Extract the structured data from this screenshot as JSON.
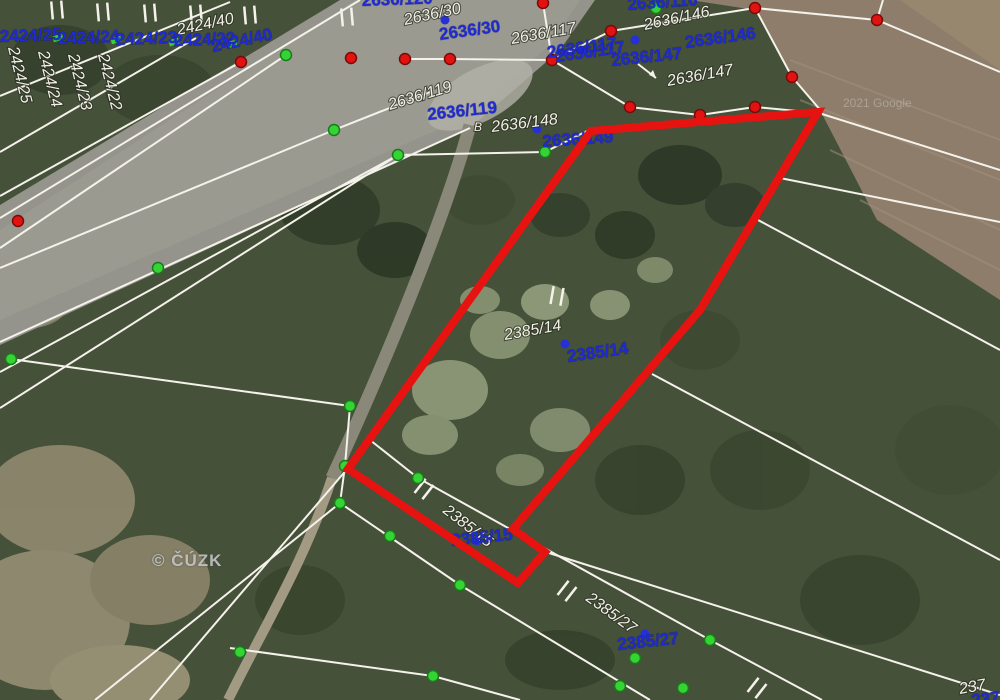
{
  "map": {
    "copyright": "© ČÚZK",
    "google_watermark": "2021 Google",
    "colors": {
      "highlight_red": "#e61310",
      "parcel_blue": "#1e2ad4",
      "boundary_white": "#f4f2ea",
      "point_green": "#35d435",
      "point_green_rim": "#1a7a1a",
      "point_red": "#e01310",
      "point_red_rim": "#7a0a08",
      "anchor_blue": "#2531d6"
    },
    "highlight_polygon": "818,112 591,131 348,469 518,583 545,552 513,529 700,310",
    "labels_white": [
      {
        "text": "2424/25",
        "x": 8,
        "y": 48,
        "rot": 76
      },
      {
        "text": "2424/24",
        "x": 38,
        "y": 52,
        "rot": 76
      },
      {
        "text": "2424/23",
        "x": 68,
        "y": 55,
        "rot": 76
      },
      {
        "text": "2424/22",
        "x": 98,
        "y": 55,
        "rot": 76
      },
      {
        "text": "2424/40",
        "x": 178,
        "y": 35,
        "rot": -12
      },
      {
        "text": "2636/30",
        "x": 405,
        "y": 25,
        "rot": -12
      },
      {
        "text": "2636/117",
        "x": 512,
        "y": 44,
        "rot": -10
      },
      {
        "text": "2636/119",
        "x": 390,
        "y": 110,
        "rot": -17
      },
      {
        "text": "B",
        "x": 474,
        "y": 131,
        "rot": 0,
        "size": 12
      },
      {
        "text": "2636/148",
        "x": 492,
        "y": 132,
        "rot": -7
      },
      {
        "text": "2636/146",
        "x": 645,
        "y": 30,
        "rot": -12
      },
      {
        "text": "2636/147",
        "x": 668,
        "y": 86,
        "rot": -10
      },
      {
        "text": "2385/14",
        "x": 505,
        "y": 340,
        "rot": -10
      },
      {
        "text": "2385/15",
        "x": 442,
        "y": 512,
        "rot": 38
      },
      {
        "text": "2385/27",
        "x": 585,
        "y": 600,
        "rot": 36
      },
      {
        "text": "237",
        "x": 960,
        "y": 694,
        "rot": -10
      }
    ],
    "labels_blue": [
      {
        "text": "2424/25",
        "x": 0,
        "y": 42,
        "rot": -2
      },
      {
        "text": "2424/24",
        "x": 58,
        "y": 44,
        "rot": -2
      },
      {
        "text": "2424/23",
        "x": 116,
        "y": 45,
        "rot": -2
      },
      {
        "text": "2424/22",
        "x": 174,
        "y": 46,
        "rot": -2
      },
      {
        "text": "2424/40",
        "x": 213,
        "y": 52,
        "rot": -12
      },
      {
        "text": "2636/120",
        "x": 362,
        "y": 6,
        "rot": -2
      },
      {
        "text": "2636/30",
        "x": 440,
        "y": 40,
        "rot": -8
      },
      {
        "text": "2636/117",
        "x": 548,
        "y": 58,
        "rot": -8
      },
      {
        "text": "2636/117",
        "x": 556,
        "y": 62,
        "rot": -8
      },
      {
        "text": "2636/116",
        "x": 628,
        "y": 10,
        "rot": -4
      },
      {
        "text": "2636/146",
        "x": 686,
        "y": 48,
        "rot": -8
      },
      {
        "text": "2636/147",
        "x": 612,
        "y": 66,
        "rot": -6
      },
      {
        "text": "2636/119",
        "x": 428,
        "y": 120,
        "rot": -6
      },
      {
        "text": "2636/149",
        "x": 543,
        "y": 147,
        "rot": -4
      },
      {
        "text": "2385/14",
        "x": 568,
        "y": 362,
        "rot": -8
      },
      {
        "text": "2385/15",
        "x": 452,
        "y": 546,
        "rot": -6
      },
      {
        "text": "2385/27",
        "x": 618,
        "y": 650,
        "rot": -6
      },
      {
        "text": "237",
        "x": 972,
        "y": 706,
        "rot": -6
      }
    ],
    "boundary_lines": [
      "360,0 0,218",
      "470,128 0,342",
      "230,2 0,96",
      "196,38 0,152",
      "241,62 0,196",
      "286,55 0,248",
      "430,92 334,130 0,268",
      "398,155 0,372",
      "398,155 0,408",
      "11,359 350,406 345,466",
      "398,155 545,152 589,130",
      "405,59 450,59 552,60 611,31 755,8 877,20 883,0",
      "552,60 543,3",
      "552,60 630,107 700,115 755,107 818,113",
      "755,8 792,77 822,112",
      "877,20 1000,72",
      "822,114 1000,170",
      "780,178 1000,222",
      "758,220 1000,350",
      "652,374 1000,560",
      "549,553 1000,695",
      "370,440 418,478 710,640 822,700",
      "340,503 460,585 650,700",
      "348,468 150,700",
      "340,503 95,700",
      "345,466 340,503",
      "230,648 433,676 520,700"
    ],
    "points_red": [
      [
        543,
        3
      ],
      [
        755,
        8
      ],
      [
        877,
        20
      ],
      [
        351,
        58
      ],
      [
        405,
        59
      ],
      [
        450,
        59
      ],
      [
        552,
        60
      ],
      [
        611,
        31
      ],
      [
        241,
        62
      ],
      [
        18,
        221
      ],
      [
        630,
        107
      ],
      [
        700,
        115
      ],
      [
        755,
        107
      ],
      [
        792,
        77
      ]
    ],
    "points_green": [
      [
        286,
        55
      ],
      [
        334,
        130
      ],
      [
        398,
        155
      ],
      [
        545,
        152
      ],
      [
        158,
        268
      ],
      [
        11,
        359
      ],
      [
        350,
        406
      ],
      [
        656,
        8
      ],
      [
        345,
        466
      ],
      [
        340,
        503
      ],
      [
        418,
        478
      ],
      [
        390,
        536
      ],
      [
        460,
        585
      ],
      [
        635,
        658
      ],
      [
        620,
        686
      ],
      [
        683,
        688
      ],
      [
        710,
        640
      ],
      [
        433,
        676
      ],
      [
        240,
        652
      ]
    ],
    "green_dashes": [
      [
        58,
        38
      ],
      [
        116,
        40
      ],
      [
        174,
        42
      ],
      [
        232,
        44
      ]
    ],
    "points_blue": [
      [
        445,
        20
      ],
      [
        635,
        40
      ],
      [
        537,
        129
      ],
      [
        565,
        344
      ],
      [
        477,
        541
      ],
      [
        645,
        634
      ]
    ],
    "tick_symbols": [
      {
        "x": 557,
        "y": 296,
        "rot": 10
      },
      {
        "x": 424,
        "y": 489,
        "rot": 38
      },
      {
        "x": 567,
        "y": 591,
        "rot": 38
      },
      {
        "x": 757,
        "y": 688,
        "rot": 38
      },
      {
        "x": 57,
        "y": 10,
        "rot": -5
      },
      {
        "x": 103,
        "y": 12,
        "rot": -5
      },
      {
        "x": 150,
        "y": 13,
        "rot": -5
      },
      {
        "x": 196,
        "y": 14,
        "rot": -5
      },
      {
        "x": 250,
        "y": 15,
        "rot": -5
      },
      {
        "x": 347,
        "y": 17,
        "rot": -5
      }
    ],
    "arrow": {
      "x1": 638,
      "y1": 64,
      "x2": 656,
      "y2": 78
    }
  }
}
